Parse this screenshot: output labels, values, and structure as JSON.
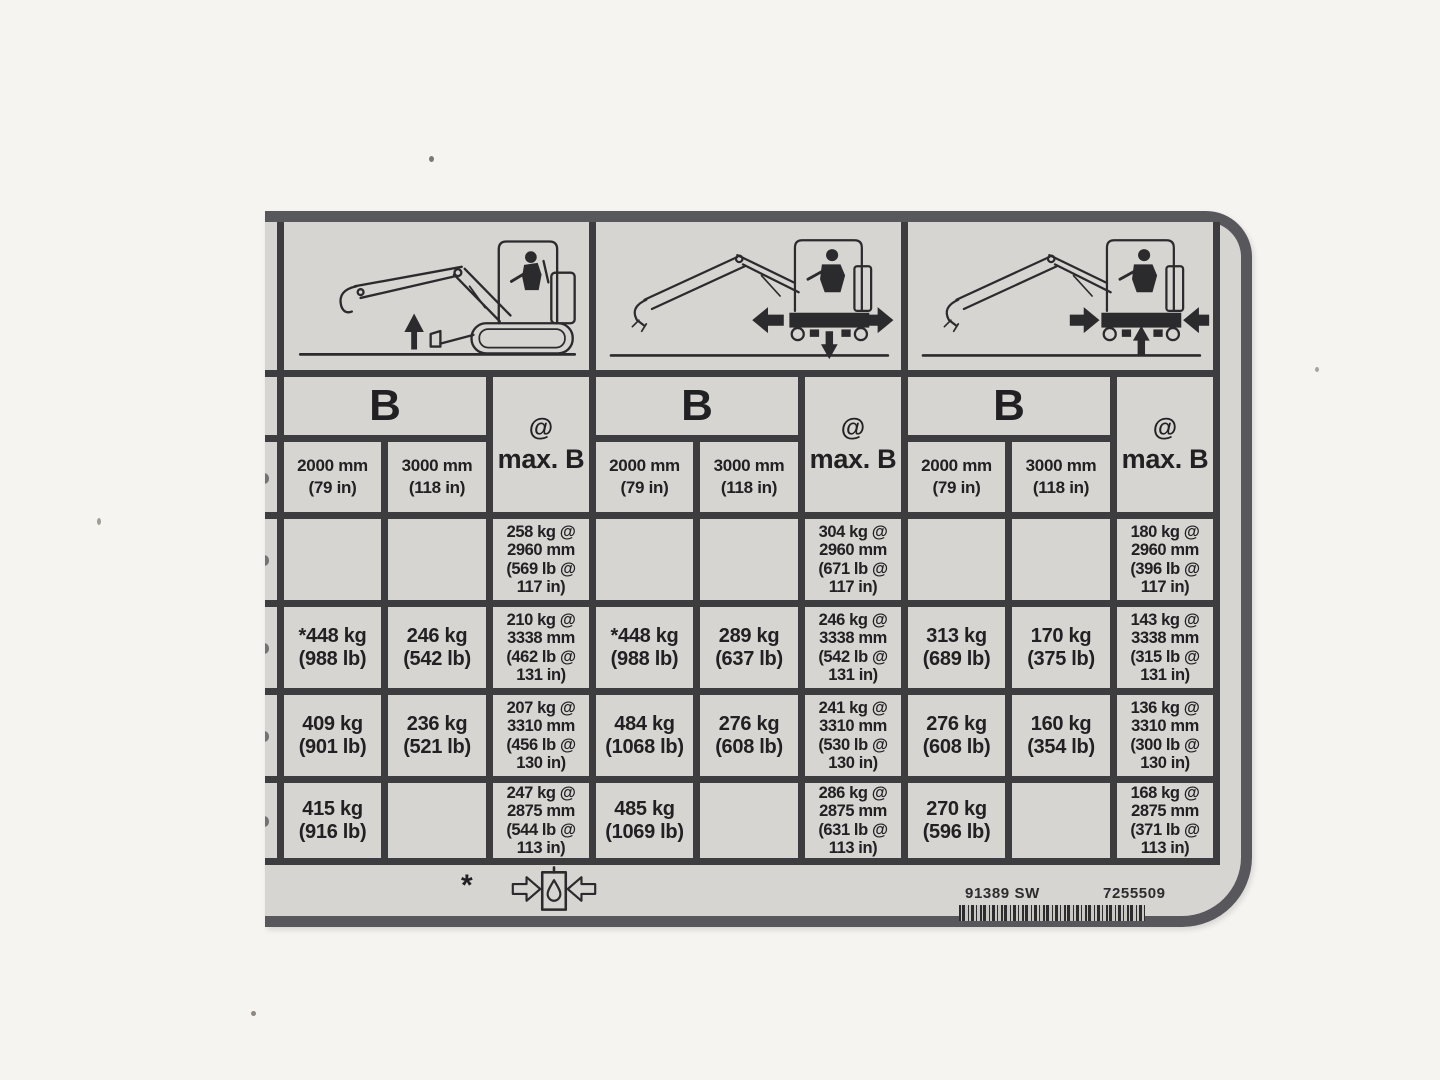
{
  "page": {
    "background": "#f5f4f1"
  },
  "label": {
    "background": "#d7d5d2",
    "border_color": "#58585c",
    "grid_color": "#3d3d40",
    "text_color": "#212123"
  },
  "columns": {
    "b": "B",
    "at": "@",
    "max_b": "max. B",
    "d2000": "2000 mm",
    "d2000_in": "(79 in)",
    "d3000": "3000 mm",
    "d3000_in": "(118 in)"
  },
  "panels": [
    {
      "diagram": "excavator-side-view-blade-arrow-up-icon",
      "rows": [
        {
          "b2000": "",
          "b3000": "",
          "maxb": "258 kg @\n2960 mm\n(569 lb @\n117 in)"
        },
        {
          "b2000": "*448 kg\n(988 lb)",
          "b3000": "246 kg\n(542 lb)",
          "maxb": "210 kg @\n3338 mm\n(462 lb @\n131 in)"
        },
        {
          "b2000": "409 kg\n(901 lb)",
          "b3000": "236 kg\n(521 lb)",
          "maxb": "207 kg @\n3310 mm\n(456 lb @\n130 in)"
        },
        {
          "b2000": "415 kg\n(916 lb)",
          "b3000": "",
          "maxb": "247 kg @\n2875 mm\n(544 lb @\n113 in)"
        }
      ]
    },
    {
      "diagram": "excavator-rear-view-arrows-out-down-icon",
      "rows": [
        {
          "b2000": "",
          "b3000": "",
          "maxb": "304 kg @\n2960 mm\n(671 lb @\n117 in)"
        },
        {
          "b2000": "*448 kg\n(988 lb)",
          "b3000": "289 kg\n(637 lb)",
          "maxb": "246 kg @\n3338 mm\n(542 lb @\n131 in)"
        },
        {
          "b2000": "484 kg\n(1068 lb)",
          "b3000": "276 kg\n(608 lb)",
          "maxb": "241 kg @\n3310 mm\n(530 lb @\n130 in)"
        },
        {
          "b2000": "485 kg\n(1069 lb)",
          "b3000": "",
          "maxb": "286 kg @\n2875 mm\n(631 lb @\n113 in)"
        }
      ]
    },
    {
      "diagram": "excavator-rear-view-arrows-in-up-icon",
      "rows": [
        {
          "b2000": "",
          "b3000": "",
          "maxb": "180 kg @\n2960 mm\n(396 lb @\n117 in)"
        },
        {
          "b2000": "313 kg\n(689 lb)",
          "b3000": "170 kg\n(375 lb)",
          "maxb": "143 kg @\n3338 mm\n(315 lb @\n131 in)"
        },
        {
          "b2000": "276 kg\n(608 lb)",
          "b3000": "160 kg\n(354 lb)",
          "maxb": "136 kg @\n3310 mm\n(300 lb @\n130 in)"
        },
        {
          "b2000": "270 kg\n(596 lb)",
          "b3000": "",
          "maxb": "168 kg @\n2875 mm\n(371 lb @\n113 in)"
        }
      ]
    }
  ],
  "footer": {
    "note": "*",
    "symbol": "hydraulic-cylinder-droplet-arrows-icon",
    "code_left": "91389 SW",
    "code_right": "7255509"
  }
}
